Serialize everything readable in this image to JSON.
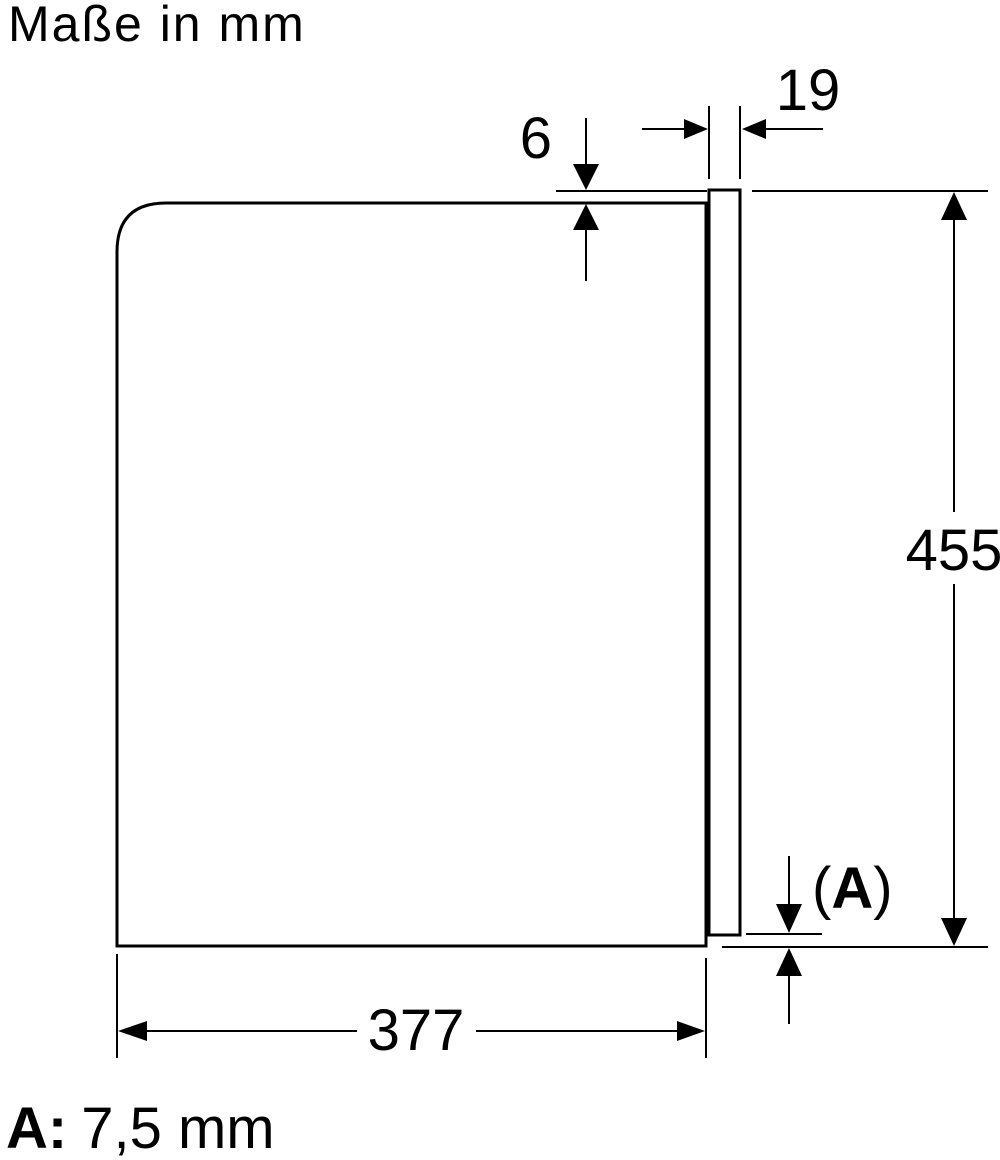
{
  "colors": {
    "ink": "#000000",
    "background": "#ffffff"
  },
  "header": {
    "title": "Maße in mm"
  },
  "dimensions": {
    "top_protrusion": "6",
    "door_thickness": "19",
    "door_height": "455",
    "body_depth": "377",
    "bottom_gap_ref": {
      "open": "(",
      "letter": "A",
      "close": ")"
    }
  },
  "footnote": {
    "label": "A:",
    "value": "7,5 mm"
  }
}
